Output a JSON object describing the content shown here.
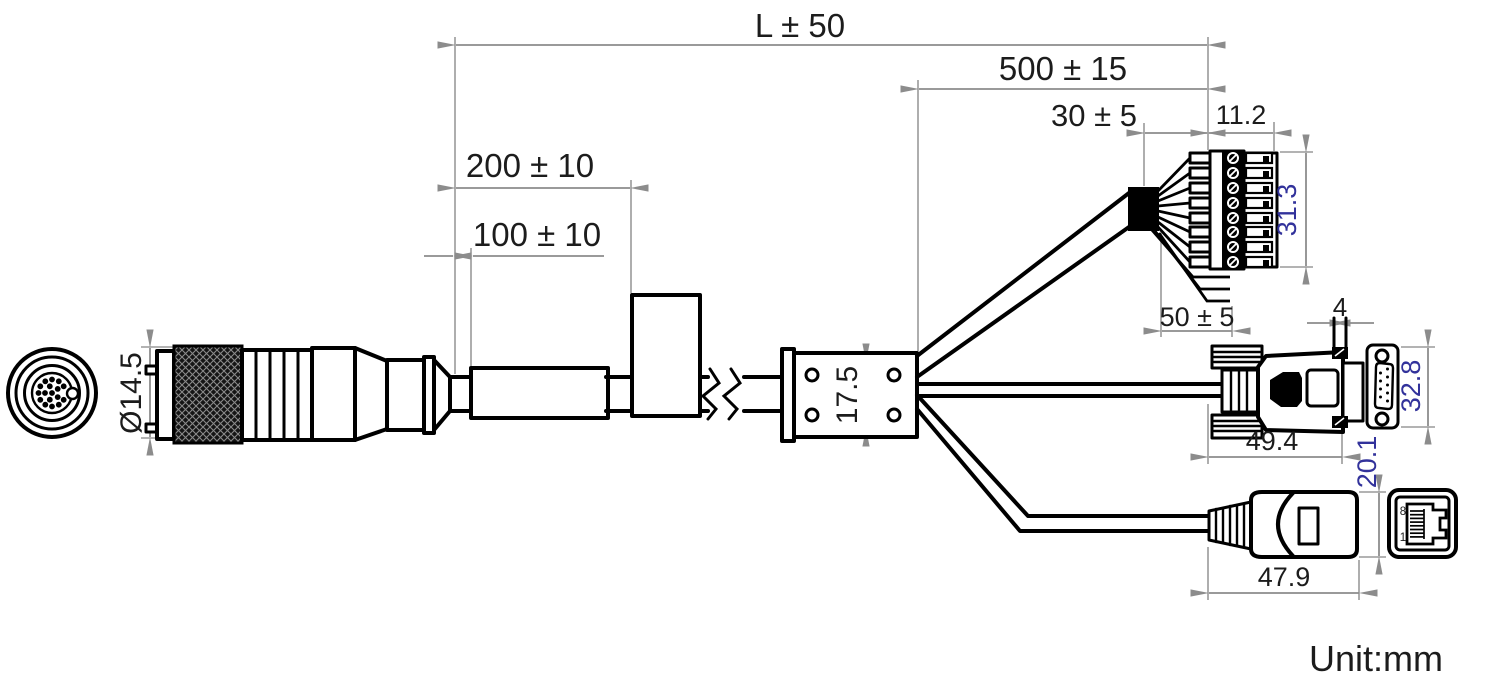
{
  "colors": {
    "object_line": "#000000",
    "dimension_line": "#8c8c8c",
    "dimension_text": "#1c1c1c",
    "rotated_dimension_text": "#32329b"
  },
  "unit_note": "Unit:mm",
  "dims": {
    "overall_length": "L ± 50",
    "branch_length": "500 ± 15",
    "jacket_strip": "30 ± 5",
    "terminal_block_width": "11.2",
    "terminal_block_height": "31.3",
    "spare_wire_length": "50 ± 5",
    "marker_position": "100 ± 10",
    "ferrite_position": "200 ± 10",
    "m12_diameter": "Ø14.5",
    "junction_height": "17.5",
    "jackscrew_width": "4",
    "dsub_front_height": "32.8",
    "dsub_length": "49.4",
    "rj45_height": "20.1",
    "rj45_length": "47.9"
  },
  "rj45_front": {
    "top_pin_label": "8",
    "bottom_pin_label": "1"
  }
}
